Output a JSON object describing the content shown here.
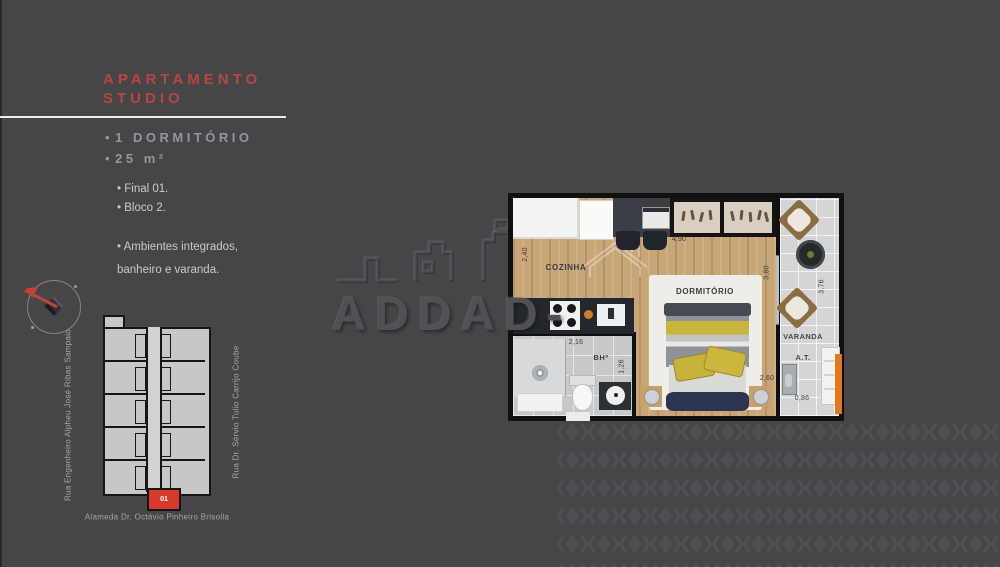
{
  "panel": {
    "title_line1": "APARTAMENTO",
    "title_line2": "STUDIO",
    "features": [
      "1 DORMITÓRIO",
      "25 m²"
    ],
    "details": [
      "Final 01.",
      "Bloco 2."
    ],
    "description": [
      "Ambientes integrados,",
      "banheiro e varanda."
    ]
  },
  "site_plan": {
    "unit_number": "01",
    "street_left": "Rua Engenheiro Alpheu José Ribas Sampaio",
    "street_right": "Rua Dr. Sérvio Tulio Carrijo Coube",
    "street_bottom": "Alameda Dr. Octávio Pinheiro Brisolla"
  },
  "floor_plan": {
    "labels": {
      "kitchen": "COZINHA",
      "bedroom": "DORMITÓRIO",
      "balcony": "VARANDA",
      "bathroom": "BHº",
      "technical_area": "A.T."
    },
    "dimensions": {
      "top_width": "4,90",
      "kitchen_depth": "2,40",
      "bedroom_depth": "3,80",
      "balcony_depth": "3,76",
      "bathroom_width": "2,16",
      "bathroom_depth": "1,26",
      "bed_width": "2,60",
      "balcony_width": "0,86"
    }
  },
  "watermark": {
    "text": "ADDAD-"
  },
  "colors": {
    "background": "#464649",
    "accent_red": "#b8463e",
    "unit_highlight_red": "#d63a2c",
    "balcony_orange": "#e07820"
  }
}
